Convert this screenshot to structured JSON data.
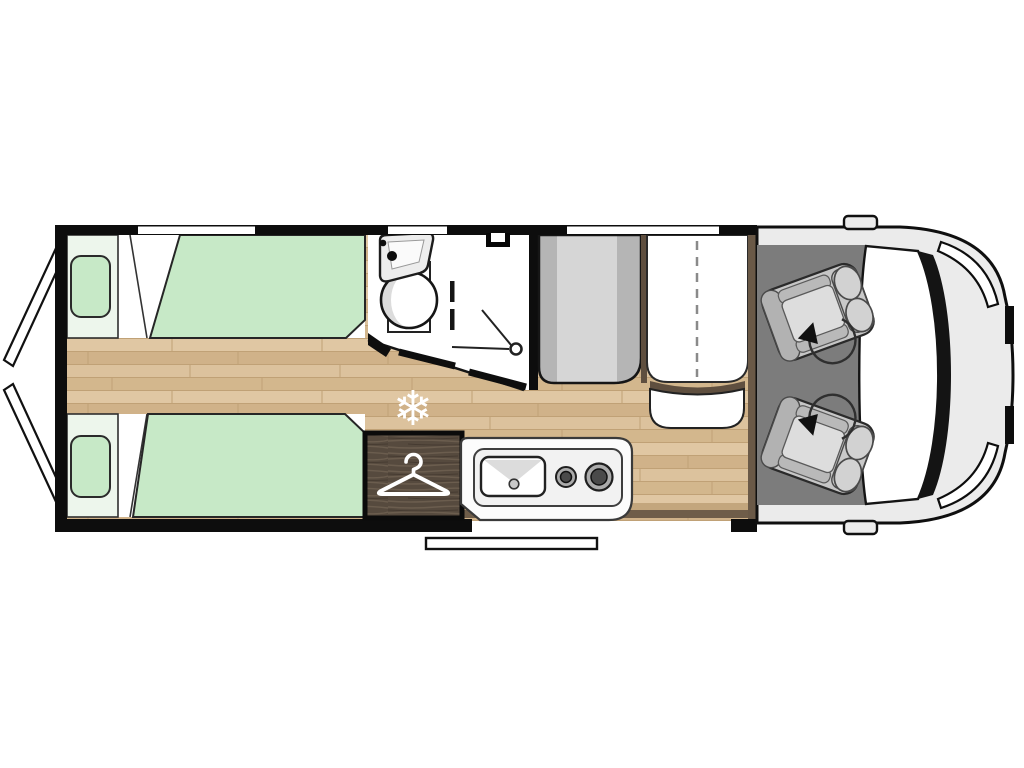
{
  "meta": {
    "type": "motorhome-floorplan",
    "view": "top-down",
    "orientation": "cab-right-rear-left"
  },
  "colors": {
    "background": "#ffffff",
    "wall": "#0d0d0d",
    "white": "#ffffff",
    "wood_base": "#d8bd94",
    "wood_shadow_light": "#c3a67d",
    "wood_shadow_dark": "#6f5d49",
    "bed_green": "#c7e9c7",
    "bed_head": "#edf6ec",
    "bench_light": "#d6d6d6",
    "bench_dark": "#b5b5b5",
    "divider_brown": "#5f4f3f",
    "cab_strip_brown": "#6a5947",
    "cab_floor": "#7c7c7c",
    "seat_base": "#c6c6c6",
    "seat_dark": "#b2b2b2",
    "seat_light": "#dddddd",
    "body_gray": "#ebebeb",
    "wardrobe_brown": "#564a3e",
    "counter_white": "#fcfcfc",
    "burner_ring": "#ababab",
    "burner_center": "#4a4a4a",
    "shading_gray": "#dcdcdc"
  },
  "icons": {
    "snowflake": "❄",
    "hanger": "coat-hanger",
    "swivel_arrow": "curved-arrow-with-head",
    "shower": "shower-head-with-spray"
  },
  "features": {
    "beds": {
      "count": 2,
      "names": [
        "rear-twin-bed-top",
        "rear-twin-bed-bottom"
      ],
      "pillows": 2
    },
    "bathroom": [
      "sink",
      "toilet",
      "shower",
      "roof-vent",
      "sliding-door"
    ],
    "kitchen": {
      "sink": 1,
      "burners": 2
    },
    "wardrobe": {
      "icon": "hanger"
    },
    "fridge_marker": {
      "icon": "snowflake"
    },
    "dinette": [
      "bench-seat",
      "folding-table",
      "small-bench"
    ],
    "cab": {
      "swivel_seats": 2,
      "mirrors": 2,
      "headlights": 2,
      "windshield": 1
    },
    "windows_top_wall": 3,
    "rear_doors_open": 2,
    "entry_step": 1
  }
}
